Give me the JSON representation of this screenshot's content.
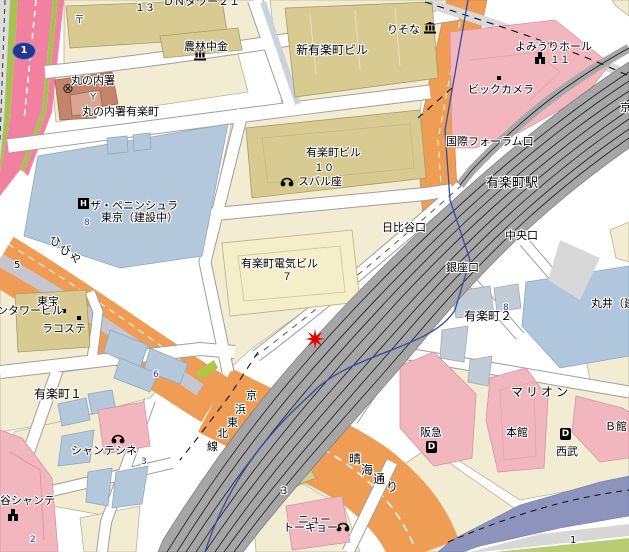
{
  "map": {
    "type": "street-map",
    "station": "有楽町駅",
    "marker": {
      "symbol": "red-star",
      "x": 315,
      "y": 339
    },
    "route_shield": {
      "number": "1"
    },
    "colors": {
      "block_cream": "#F2ECD3",
      "building_tan": "#D8CB92",
      "building_pale": "#F5EFC9",
      "building_pink": "#F2B7BE",
      "building_blue": "#B3C8DB",
      "police_brown": "#C4846B",
      "road_orange": "#EF9D55",
      "road_pink_highway": "#F2809F",
      "greenery": "#A5C153",
      "railway_gray": "#A8A8A8",
      "expressway_purple": "#8C93BD",
      "subway_blue": "#2E4FA3",
      "marker_red": "#E60000"
    },
    "icons": [
      "bank-icon",
      "bank-icon",
      "police-station-icon",
      "post-office-icon",
      "hotel-icon",
      "cinema-icon",
      "cinema-icon",
      "cinema-icon",
      "hall-icon",
      "hall-icon",
      "department-store-icon",
      "department-store-icon",
      "route-shield-icon",
      "red-star-marker",
      "entrance-dot",
      "entrance-dot",
      "entrance-dot"
    ],
    "labels": [
      {
        "name": "label-dn-tower21",
        "text": "ＤＮタワー２１",
        "x": 163,
        "y": -4
      },
      {
        "name": "label-num-13",
        "text": "１３",
        "x": 135,
        "y": 3,
        "size": 10
      },
      {
        "name": "label-post-mark",
        "text": "〒",
        "x": 74,
        "y": 14,
        "color": "#445"
      },
      {
        "name": "label-norinchukin",
        "text": "農林中金",
        "x": 184,
        "y": 41
      },
      {
        "name": "label-marunouchi-police",
        "text": "丸の内署",
        "x": 71,
        "y": 75
      },
      {
        "name": "label-y-mark",
        "text": "Y",
        "x": 90,
        "y": 92,
        "size": 10,
        "color": "#333"
      },
      {
        "name": "label-police-yurakucho",
        "text": "丸の内署有楽町",
        "x": 82,
        "y": 106
      },
      {
        "name": "label-shin-yurakucho-bldg",
        "text": "新有楽町ビル",
        "x": 296,
        "y": 44,
        "size": 12
      },
      {
        "name": "label-resona",
        "text": "りそな",
        "x": 387,
        "y": 24
      },
      {
        "name": "label-yomiuri-hall",
        "text": "よみうりホール",
        "x": 515,
        "y": 41
      },
      {
        "name": "label-num-11",
        "text": "１１",
        "x": 550,
        "y": 55,
        "size": 10
      },
      {
        "name": "label-bic-camera",
        "text": "ビックカメラ",
        "x": 468,
        "y": 84
      },
      {
        "name": "label-intl-forum-exit",
        "text": "国際フォーラム口",
        "x": 446,
        "y": 136
      },
      {
        "name": "label-yurakucho-bldg",
        "text": "有楽町ビル",
        "x": 306,
        "y": 147
      },
      {
        "name": "label-num-10",
        "text": "１０",
        "x": 314,
        "y": 163,
        "size": 10
      },
      {
        "name": "label-subaru-za",
        "text": "スバル座",
        "x": 298,
        "y": 176
      },
      {
        "name": "label-peninsula-1",
        "text": "ザ・ペニンシュラ",
        "x": 90,
        "y": 200
      },
      {
        "name": "label-peninsula-2",
        "text": "東京（建設中）",
        "x": 101,
        "y": 212
      },
      {
        "name": "label-num-8a",
        "text": "8",
        "x": 84,
        "y": 219,
        "size": 9,
        "blue": true
      },
      {
        "name": "label-hibiya-1",
        "text": "ひ",
        "x": 50,
        "y": 236
      },
      {
        "name": "label-hibiya-2",
        "text": "び",
        "x": 60,
        "y": 245
      },
      {
        "name": "label-hibiya-3",
        "text": "や",
        "x": 70,
        "y": 253
      },
      {
        "name": "label-yurakucho-denki",
        "text": "有楽町電気ビル",
        "x": 241,
        "y": 258
      },
      {
        "name": "label-num-7",
        "text": "７",
        "x": 282,
        "y": 272,
        "size": 10
      },
      {
        "name": "label-hibiya-exit",
        "text": "日比谷口",
        "x": 382,
        "y": 222
      },
      {
        "name": "label-yurakucho-station",
        "text": "有楽町駅",
        "x": 486,
        "y": 177,
        "size": 13
      },
      {
        "name": "label-chuo-exit",
        "text": "中央口",
        "x": 505,
        "y": 230
      },
      {
        "name": "label-ginza-exit",
        "text": "銀座口",
        "x": 446,
        "y": 262
      },
      {
        "name": "label-marui",
        "text": "丸井（建設中）",
        "x": 591,
        "y": 298
      },
      {
        "name": "label-num-8b",
        "text": "8",
        "x": 503,
        "y": 304,
        "size": 9,
        "blue": true
      },
      {
        "name": "label-yurakucho-2",
        "text": "有楽町２",
        "x": 464,
        "y": 310,
        "size": 12
      },
      {
        "name": "label-num-5",
        "text": "5",
        "x": 14,
        "y": 260,
        "size": 10
      },
      {
        "name": "label-toho",
        "text": "東宝",
        "x": 37,
        "y": 296
      },
      {
        "name": "label-twin-tower",
        "text": "ンタワービル",
        "x": -3,
        "y": 305
      },
      {
        "name": "label-lacoste",
        "text": "ラコステ",
        "x": 42,
        "y": 323
      },
      {
        "name": "label-num-6",
        "text": "6",
        "x": 153,
        "y": 371,
        "size": 9,
        "blue": true
      },
      {
        "name": "label-yurakucho-1",
        "text": "有楽町１",
        "x": 34,
        "y": 388,
        "size": 12
      },
      {
        "name": "label-chanter-cine",
        "text": "シャンテシネ",
        "x": 71,
        "y": 445
      },
      {
        "name": "label-num-3a",
        "text": "3",
        "x": 141,
        "y": 458,
        "size": 9,
        "blue": true
      },
      {
        "name": "label-tani-chanter",
        "text": "谷シャンテ",
        "x": 0,
        "y": 495
      },
      {
        "name": "label-num-2",
        "text": "2",
        "x": 30,
        "y": 536,
        "size": 9,
        "blue": true
      },
      {
        "name": "label-keihin-1",
        "text": "京",
        "x": 246,
        "y": 390
      },
      {
        "name": "label-keihin-2",
        "text": "浜",
        "x": 235,
        "y": 404
      },
      {
        "name": "label-keihin-3",
        "text": "東",
        "x": 227,
        "y": 417
      },
      {
        "name": "label-keihin-4",
        "text": "北",
        "x": 217,
        "y": 428
      },
      {
        "name": "label-keihin-5",
        "text": "線",
        "x": 207,
        "y": 441
      },
      {
        "name": "label-harumi-1",
        "text": "晴",
        "x": 349,
        "y": 453,
        "size": 12
      },
      {
        "name": "label-harumi-2",
        "text": "海",
        "x": 361,
        "y": 464,
        "size": 12
      },
      {
        "name": "label-harumi-3",
        "text": "通",
        "x": 373,
        "y": 473,
        "size": 12
      },
      {
        "name": "label-harumi-4",
        "text": "り",
        "x": 386,
        "y": 481,
        "size": 12
      },
      {
        "name": "label-num-3b",
        "text": "３",
        "x": 279,
        "y": 486,
        "size": 10
      },
      {
        "name": "label-new-tokyo-1",
        "text": "ニュー",
        "x": 298,
        "y": 514
      },
      {
        "name": "label-new-tokyo-2",
        "text": "トーキョー",
        "x": 283,
        "y": 522
      },
      {
        "name": "label-marion",
        "text": "マリオン",
        "x": 511,
        "y": 386,
        "size": 12,
        "ls": 3
      },
      {
        "name": "label-hankyu",
        "text": "阪急",
        "x": 420,
        "y": 427
      },
      {
        "name": "label-honkan",
        "text": "本館",
        "x": 506,
        "y": 427
      },
      {
        "name": "label-seibu",
        "text": "西武",
        "x": 556,
        "y": 446
      },
      {
        "name": "label-b-kan",
        "text": "Ｂ館",
        "x": 605,
        "y": 421
      },
      {
        "name": "label-num-1",
        "text": "1",
        "x": 570,
        "y": 535,
        "size": 10
      },
      {
        "name": "label-kyo",
        "text": "京",
        "x": 620,
        "y": 102
      }
    ]
  }
}
